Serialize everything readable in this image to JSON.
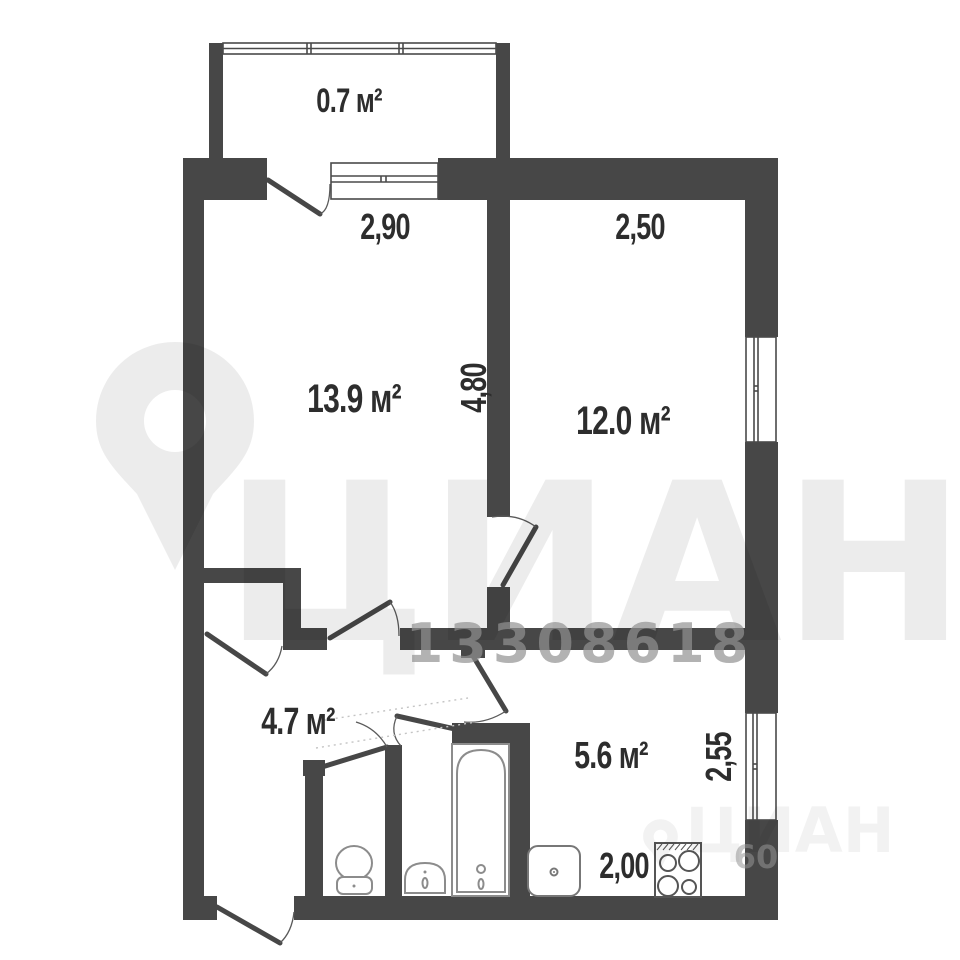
{
  "plan": {
    "type": "apartment-floor-plan",
    "rooms": [
      {
        "name": "balcony",
        "area": "0.7 м²"
      },
      {
        "name": "living-room",
        "area": "13.9 м²"
      },
      {
        "name": "bedroom",
        "area": "12.0 м²"
      },
      {
        "name": "hallway",
        "area": "4.7 м²"
      },
      {
        "name": "kitchen",
        "area": "5.6 м²"
      }
    ],
    "dimensions": {
      "balcony_width": "2,90",
      "bedroom_width": "2,50",
      "living_room_depth": "4,80",
      "kitchen_depth": "2,55",
      "kitchen_width": "2,00"
    },
    "fixtures": [
      "toilet",
      "washbasin",
      "bathtub",
      "kitchen-sink",
      "stove"
    ],
    "colors": {
      "wall": "#474747",
      "background": "#ffffff",
      "label_text": "#2d2d2d"
    }
  },
  "watermark": {
    "brand": "ЦИАН",
    "listing_id": "13308618",
    "corner_brand": "ЦИАН",
    "corner_number": "60"
  }
}
